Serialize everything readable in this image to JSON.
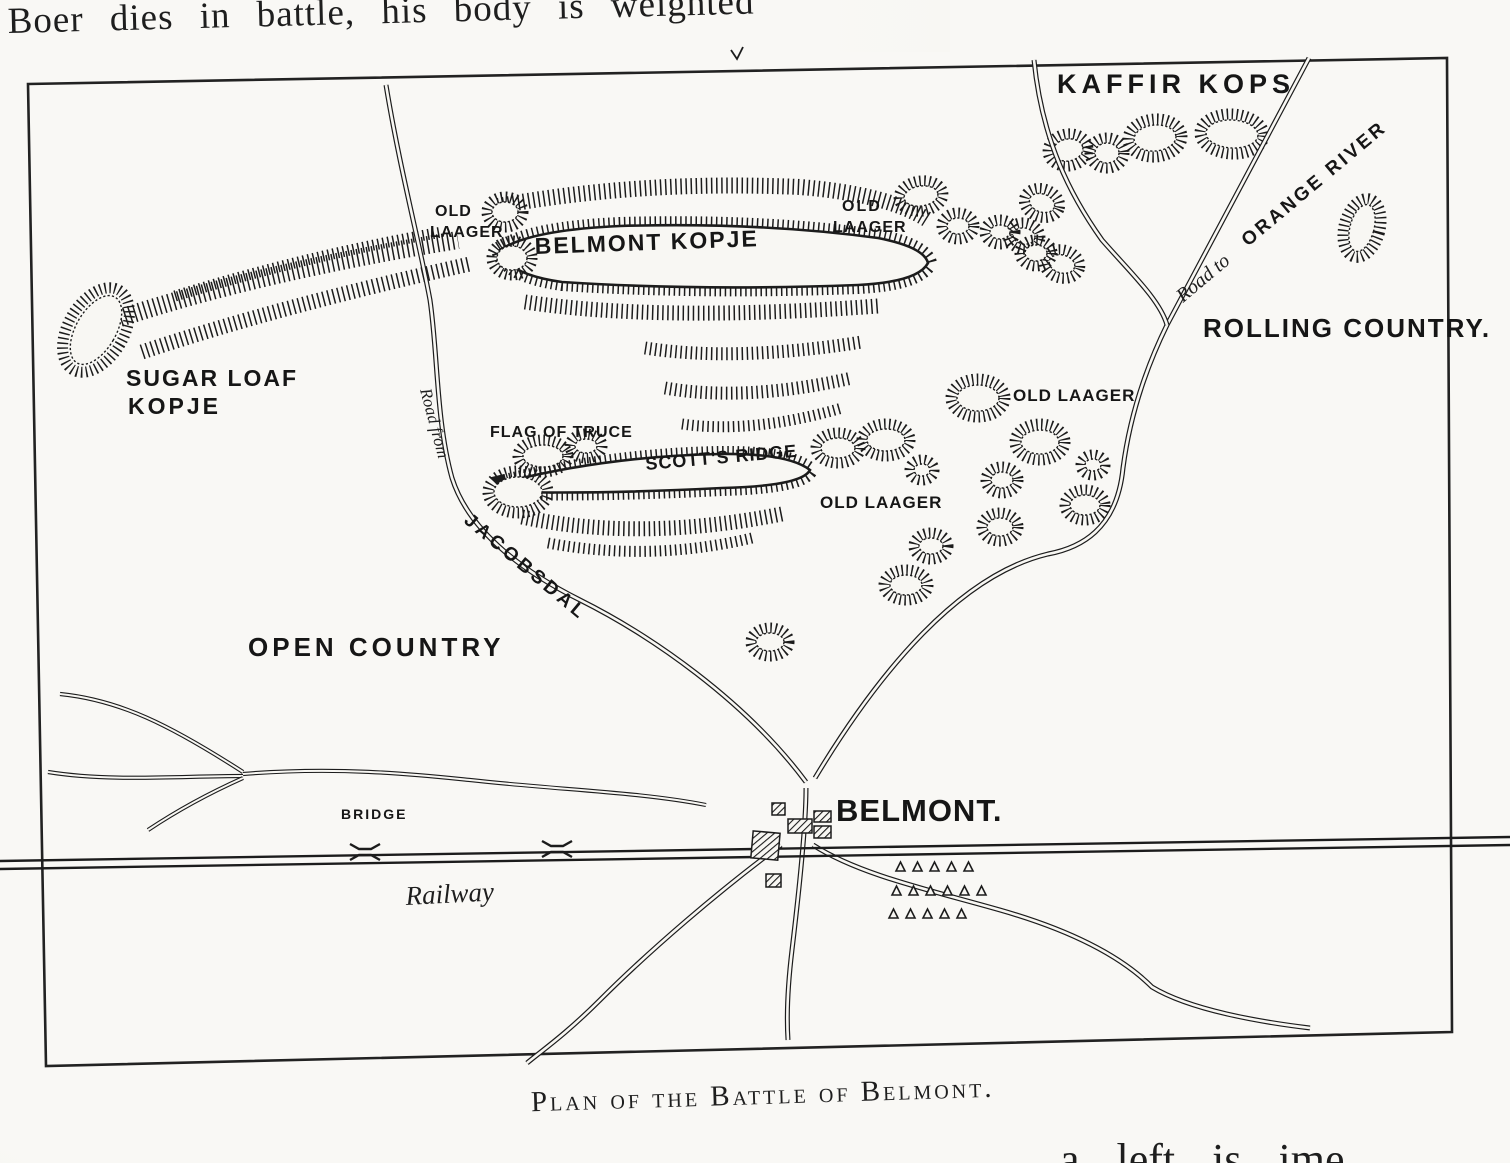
{
  "page": {
    "top_cutoff_text": "Boer dies in battle, his body is weighted",
    "caption": "Plan of the Battle of Belmont.",
    "bottom_cutoff_text": "a left is ime"
  },
  "map": {
    "regions": {
      "kaffir_kops": "KAFFIR KOPS",
      "rolling_country": "ROLLING COUNTRY.",
      "open_country": "OPEN COUNTRY"
    },
    "features": {
      "belmont_kopje": "BELMONT KOPJE",
      "sugar_loaf_line1": "SUGAR LOAF",
      "sugar_loaf_line2": "KOPJE",
      "scotts_ridge": "SCOTT'S RIDGE",
      "flag_of_truce": "FLAG OF TRUCE",
      "old_laager_line1": "OLD",
      "old_laager_line2": "LAAGER",
      "old_laager_east": "OLD LAAGER",
      "old_laager_south": "OLD LAAGER"
    },
    "roads": {
      "road_to": "Road to",
      "orange_river": "ORANGE RIVER",
      "road_from": "Road from",
      "jacobsdal": "JACOBSDAL"
    },
    "town": {
      "belmont": "BELMONT."
    },
    "railway": {
      "label": "Railway",
      "bridge": "BRIDGE"
    }
  },
  "colors": {
    "ink": "#1c1c1c",
    "paper": "#f8f7f3"
  }
}
